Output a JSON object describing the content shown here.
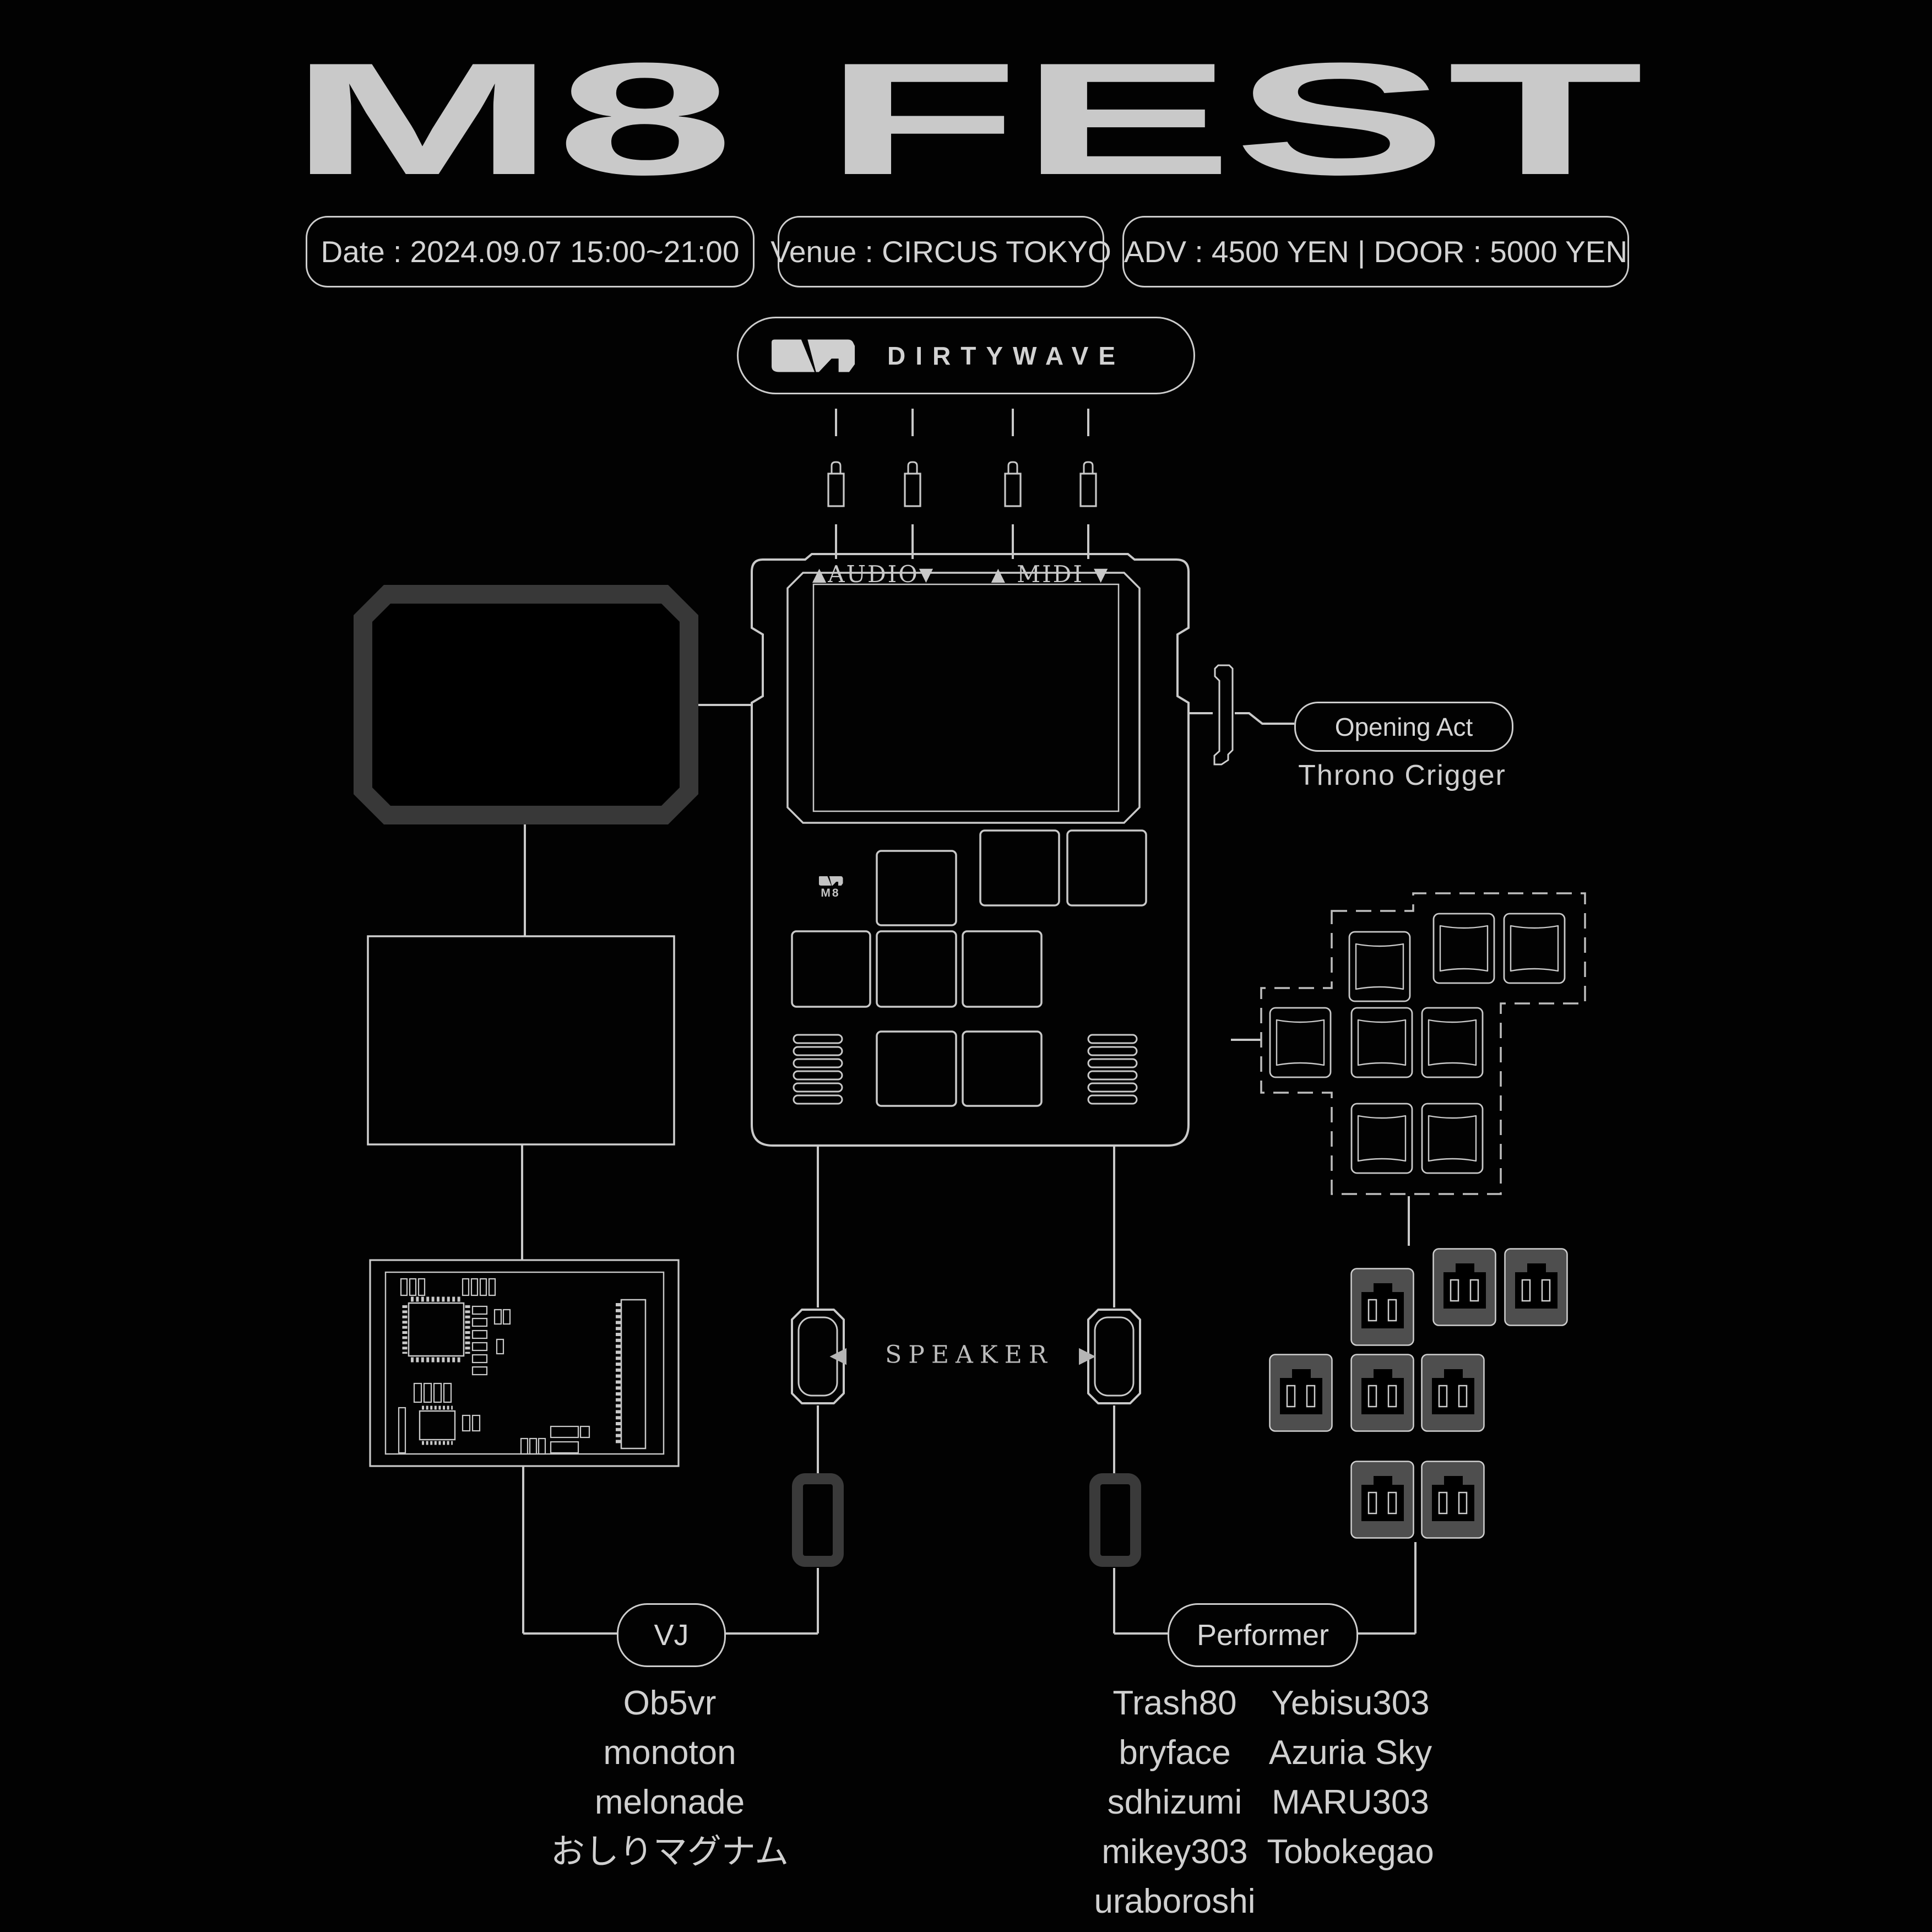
{
  "title": "M8 FEST",
  "info": {
    "date": "Date : 2024.09.07 15:00~21:00",
    "venue": "Venue : CIRCUS TOKYO",
    "price": "ADV : 4500 YEN | DOOR : 5000 YEN"
  },
  "brand": {
    "name": "DIRTYWAVE",
    "device_logo": "M8"
  },
  "ports": {
    "audio": "AUDIO",
    "midi": "MIDI",
    "up_arrow": "▲",
    "down_arrow": "▼"
  },
  "speaker": {
    "label": "SPEAKER",
    "left_arrow": "◀",
    "right_arrow": "▶"
  },
  "opening_act": {
    "label": "Opening Act",
    "artist": "Throno Crigger"
  },
  "vj": {
    "label": "VJ",
    "names": [
      "Ob5vr",
      "monoton",
      "melonade",
      "おしりマグナム"
    ]
  },
  "performer": {
    "label": "Performer",
    "column1": [
      "Trash80",
      "bryface",
      "sdhizumi",
      "mikey303",
      "uraboroshi"
    ],
    "column2": [
      "Yebisu303",
      "Azuria Sky",
      "MARU303",
      "Tobokegao"
    ]
  },
  "colors": {
    "background": "#020202",
    "line": "#c9c9c9",
    "dim": "#3a3a3a",
    "outlet_fill": "#4e4e4e"
  }
}
